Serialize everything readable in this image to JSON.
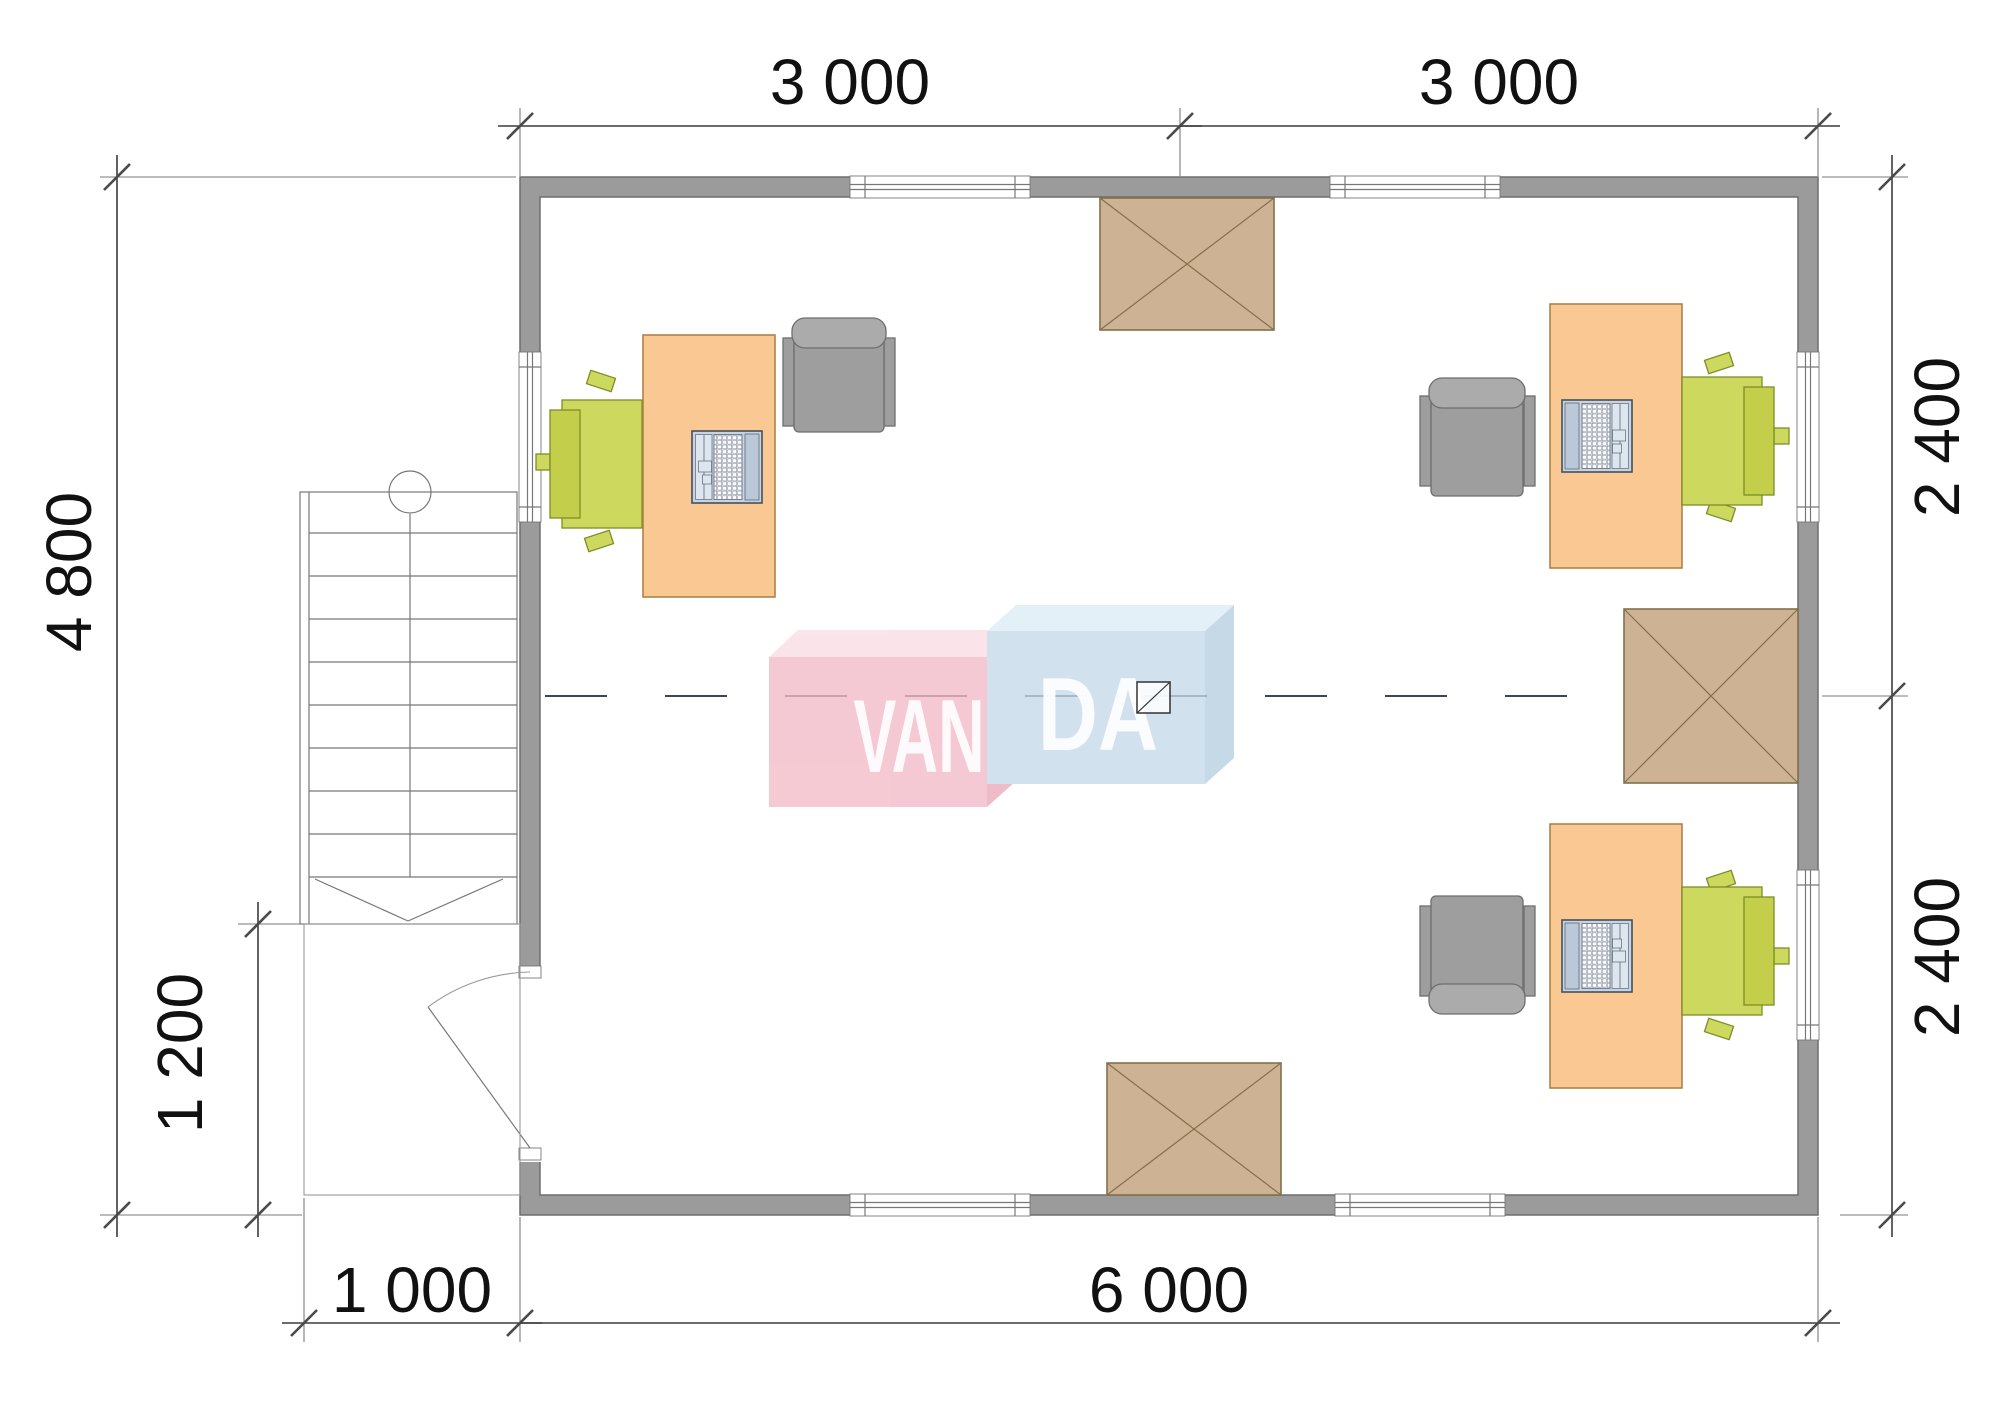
{
  "drawing": {
    "type": "floor-plan",
    "dimensions": {
      "top_left": "3 000",
      "top_right": "3 000",
      "left_overall": "4 800",
      "left_entry": "1 200",
      "right_upper": "2 400",
      "right_lower": "2 400",
      "bottom_entry": "1 000",
      "bottom_overall": "6 000"
    },
    "watermark": {
      "left": "VAN",
      "right": "DA"
    },
    "colors": {
      "wall": "#9b9b9b",
      "wall_edge": "#6e6e6e",
      "ext": "#7a7a7a",
      "line": "#3c3c3c",
      "text": "#111111",
      "desk": "#fac893",
      "desk_edge": "#ad8348",
      "chair_green": "#cdd95e",
      "chair_green_dark": "#c3cf4a",
      "chair_green_edge": "#7e8d24",
      "chair_gray": "#9e9e9e",
      "chair_gray_light": "#ababab",
      "chair_gray_edge": "#6e6e6e",
      "hatch": "#cdb394",
      "hatch_edge": "#83704a",
      "laptop": "#c9d4e2",
      "laptop_edge": "#44505e",
      "pink_front": "#f3bbc7",
      "pink_top": "#fadde4",
      "pink_side": "#eaa9b8",
      "blue_front": "#c6d9ea",
      "blue_top": "#ddecf7",
      "blue_side": "#b7cfe1"
    }
  }
}
